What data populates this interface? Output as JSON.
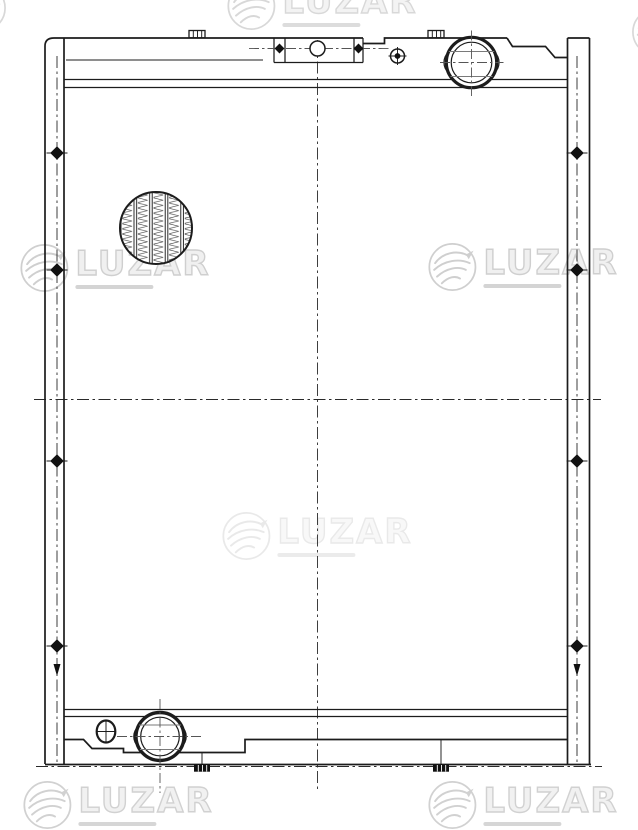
{
  "document": {
    "kind": "technical-line-drawing",
    "subject": "radiator-front-view",
    "background_color": "#ffffff",
    "line_color": "#1c1c1c",
    "centerline_color": "#2a2a2a"
  },
  "watermark": {
    "text": "LUZAR",
    "logo": "luzar-bird-swoosh-logo",
    "color": "#cfcfcf",
    "tagline_bar_color": "#d4d4d4",
    "instances": [
      {
        "x": 322,
        "y": 6,
        "opacity": 0.8
      },
      {
        "x": 115,
        "y": 268,
        "opacity": 1
      },
      {
        "x": 523,
        "y": 267,
        "opacity": 1
      },
      {
        "x": 317,
        "y": 536,
        "opacity": 0.45
      },
      {
        "x": 118,
        "y": 805,
        "opacity": 0.95
      },
      {
        "x": 523,
        "y": 805,
        "opacity": 0.95
      },
      {
        "x": -18,
        "y": 8,
        "logo_only": true,
        "opacity": 0.8
      },
      {
        "x": 656,
        "y": 32,
        "logo_only": true,
        "opacity": 0.8
      }
    ]
  },
  "drawing": {
    "features": [
      "side-mounting-bracket-left",
      "side-mounting-bracket-right",
      "top-tank",
      "bottom-tank",
      "radiator-core",
      "filler-neck",
      "outlet-pipe",
      "drain-plug",
      "top-mounting-plate",
      "bolt-hole",
      "mounting-pins",
      "core-fins-detail-circle",
      "centerlines",
      "fixing-bolts"
    ]
  }
}
